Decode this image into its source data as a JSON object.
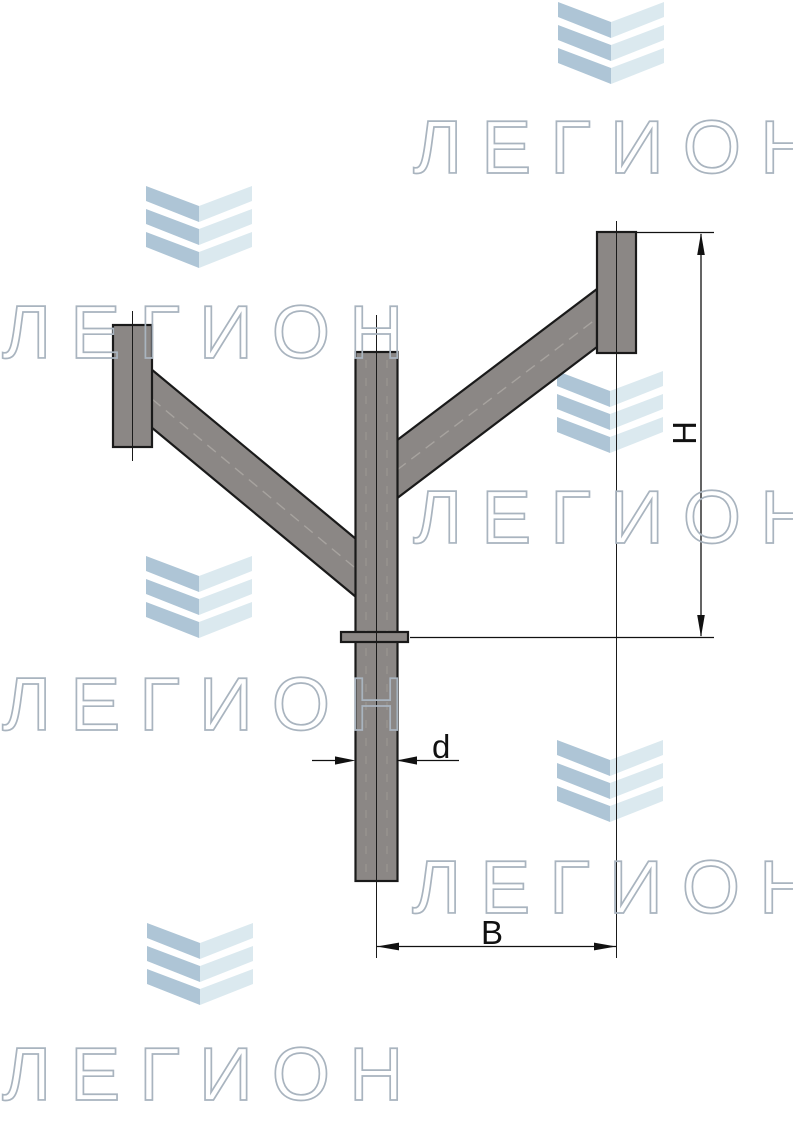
{
  "watermark": {
    "text": "ЛЕГИОН",
    "text_color": "#aeb8c2",
    "logo": {
      "dark_color": "#aec5d6",
      "light_color": "#dbe9ef"
    }
  },
  "drawing": {
    "dimension_labels": {
      "height": "Н",
      "width": "В",
      "diameter": "d"
    },
    "line_color": "#1a1a1a",
    "metal_fill": "#8b8785"
  }
}
